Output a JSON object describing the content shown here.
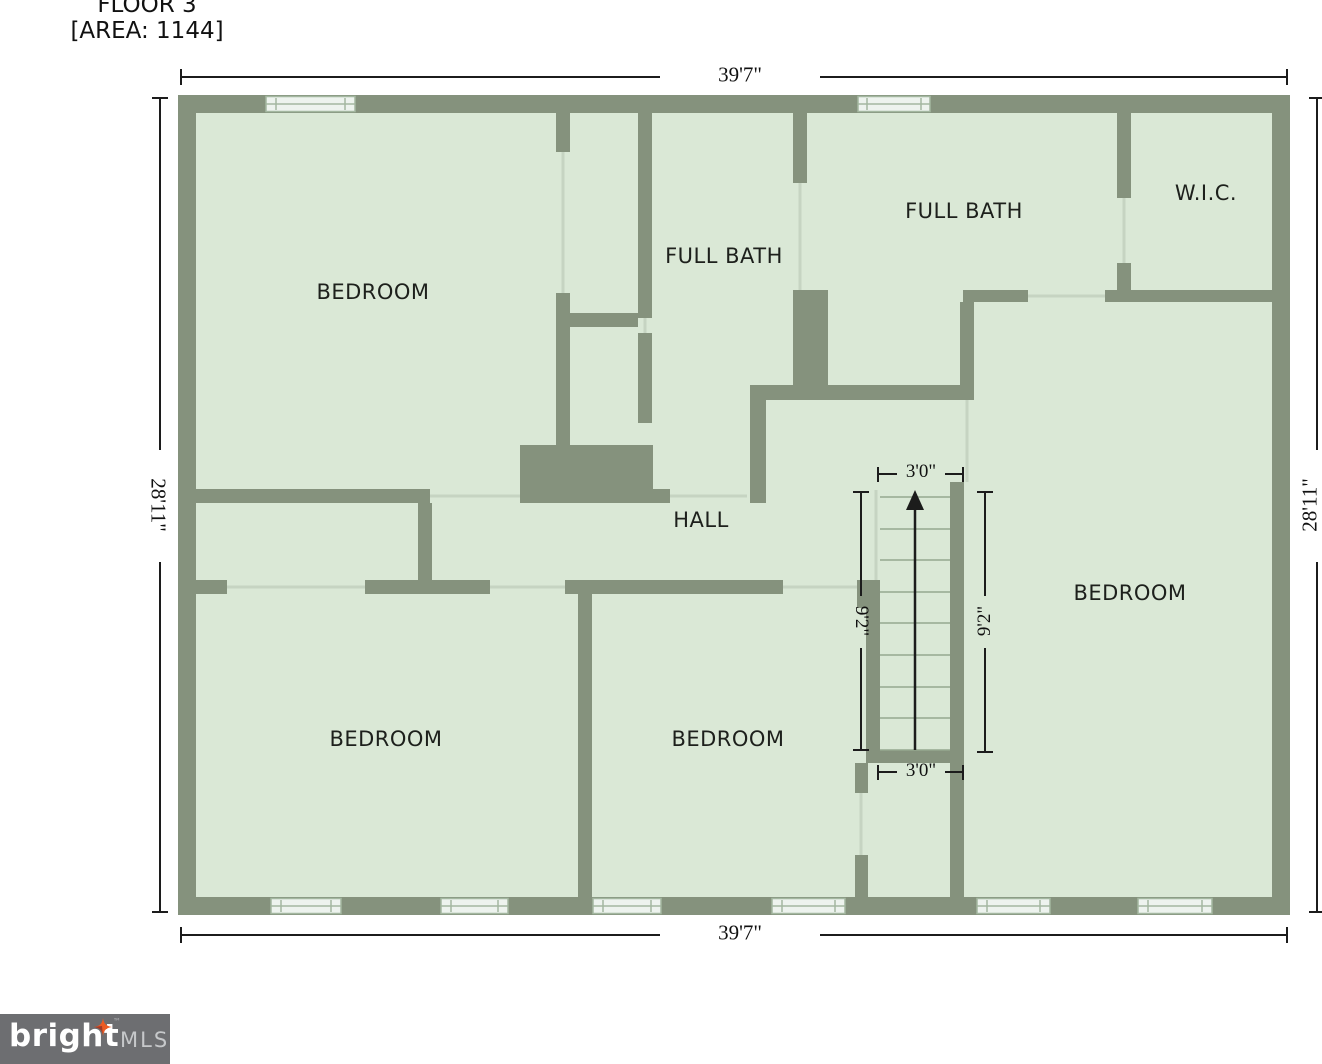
{
  "page_title": {
    "floor": "FLOOR 3",
    "area": "[AREA: 1144]"
  },
  "rooms": [
    {
      "id": "bedroom-top-left",
      "label": "BEDROOM"
    },
    {
      "id": "full-bath-center",
      "label": "FULL BATH"
    },
    {
      "id": "full-bath-right",
      "label": "FULL BATH"
    },
    {
      "id": "walk-in-closet",
      "label": "W.I.C."
    },
    {
      "id": "hall",
      "label": "HALL"
    },
    {
      "id": "bedroom-right",
      "label": "BEDROOM"
    },
    {
      "id": "bedroom-bottom-left",
      "label": "BEDROOM"
    },
    {
      "id": "bedroom-bottom-center",
      "label": "BEDROOM"
    }
  ],
  "dimensions": {
    "top_width": "39'7\"",
    "bottom_width": "39'7\"",
    "left_height": "28'11\"",
    "right_height": "28'11\"",
    "stairs_top_width": "3'0\"",
    "stairs_bottom_width": "3'0\"",
    "stairs_left_height": "9'2\"",
    "stairs_right_height": "9'2\""
  },
  "staircase": {
    "direction_arrow": "up"
  },
  "colors": {
    "wall": "#85927d",
    "room_fill": "#dae8d6",
    "window_fill": "#edf3ee",
    "dimension_ink": "#1c1c1c",
    "logo_background": "#6d6e71",
    "logo_star": "#ed5b23"
  },
  "logo": {
    "brand": "bright",
    "trademark": "™",
    "suffix": "MLS"
  }
}
